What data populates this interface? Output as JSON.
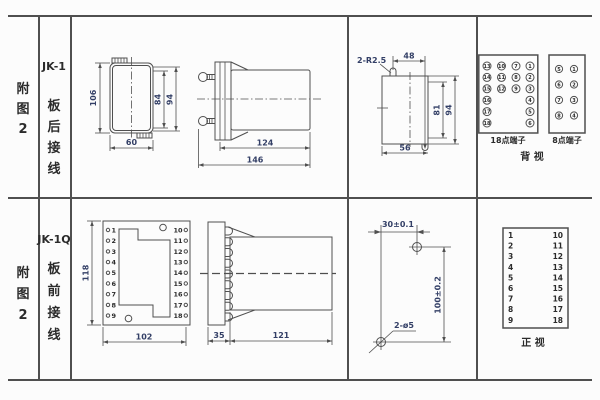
{
  "sheet": {
    "rows": [
      {
        "figure_chars": [
          "附",
          "图",
          "2"
        ],
        "model": "JK-1",
        "mode_chars": [
          "板",
          "后",
          "接",
          "线"
        ]
      },
      {
        "figure_chars": [
          "附",
          "图",
          "2"
        ],
        "model": "JK-1Q",
        "mode_chars": [
          "板",
          "前",
          "接",
          "线"
        ]
      }
    ]
  },
  "top_row": {
    "front_view": {
      "dim_height": "106",
      "dim_width": "60",
      "dim_inner_height": "84",
      "dim_outer_height": "94"
    },
    "side_view": {
      "dim_body": "124",
      "dim_total": "146"
    },
    "cutout": {
      "radius_note": "2-R2.5",
      "dim_top": "48",
      "dim_inner_height": "81",
      "dim_outer_height": "94",
      "dim_width": "56"
    },
    "terminals_18": {
      "label": "18点端子",
      "columns": [
        [
          "13",
          "14",
          "15",
          "16",
          "17",
          "18"
        ],
        [
          "10",
          "11",
          "12"
        ],
        [
          "7",
          "8",
          "9"
        ],
        [
          "1",
          "2",
          "3",
          "4",
          "5",
          "6"
        ]
      ]
    },
    "terminals_8": {
      "label": "8点端子",
      "columns": [
        [
          "5",
          "6",
          "7",
          "8"
        ],
        [
          "1",
          "2",
          "3",
          "4"
        ]
      ]
    },
    "view_label": "背  视"
  },
  "bottom_row": {
    "front_view": {
      "dim_height": "118",
      "dim_width": "102",
      "left_terminals": [
        "1",
        "2",
        "3",
        "4",
        "5",
        "6",
        "7",
        "8",
        "9"
      ],
      "right_terminals": [
        "10",
        "11",
        "12",
        "13",
        "14",
        "15",
        "16",
        "17",
        "18"
      ]
    },
    "side_view": {
      "dim_plate": "35",
      "dim_body": "121"
    },
    "drill_plan": {
      "dim_horizontal": "30±0.1",
      "dim_vertical": "100±0.2",
      "hole_note": "2-ø5"
    },
    "terminal_table": {
      "left": [
        "1",
        "2",
        "3",
        "4",
        "5",
        "6",
        "7",
        "8",
        "9"
      ],
      "right": [
        "10",
        "11",
        "12",
        "13",
        "14",
        "15",
        "16",
        "17",
        "18"
      ]
    },
    "view_label": "正  视"
  }
}
